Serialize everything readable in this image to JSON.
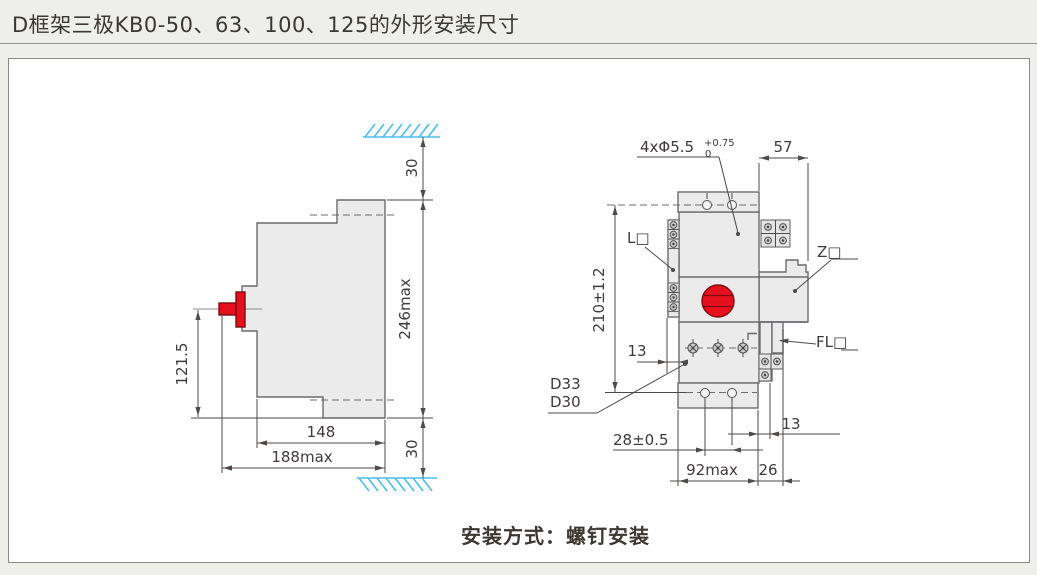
{
  "title": "D框架三极KB0-50、63、100、125的外形安装尺寸",
  "caption": "安装方式：螺钉安装",
  "side_view": {
    "dim_top_clearance": "30",
    "dim_height_max": "246max",
    "dim_bottom_clearance": "30",
    "dim_handle_height": "121.5",
    "dim_depth": "148",
    "dim_depth_max": "188max"
  },
  "front_view": {
    "callout_holes": {
      "text": "4xΦ5.5",
      "tol_plus": "+0.75",
      "tol_minus": "0"
    },
    "dim_top_width": "57",
    "dim_mount_height": "210±1.2",
    "dim_terminal_offset": "13",
    "dim_hole_spacing": "28±0.5",
    "dim_width_max": "92max",
    "dim_right_ext": "26",
    "dim_right_gap": "13",
    "label_left_accessory": "L□",
    "label_right_accessory": "Z□",
    "label_fl_accessory": "FL□",
    "label_frame_1": "D33",
    "label_frame_2": "D30"
  },
  "colors": {
    "accent_red": "#E60F1E",
    "hatch_blue": "#4DBEEA",
    "body_gray": "#EBEBEB",
    "outline_gray": "#6A6B6E",
    "text_dark": "#3E3A39"
  }
}
